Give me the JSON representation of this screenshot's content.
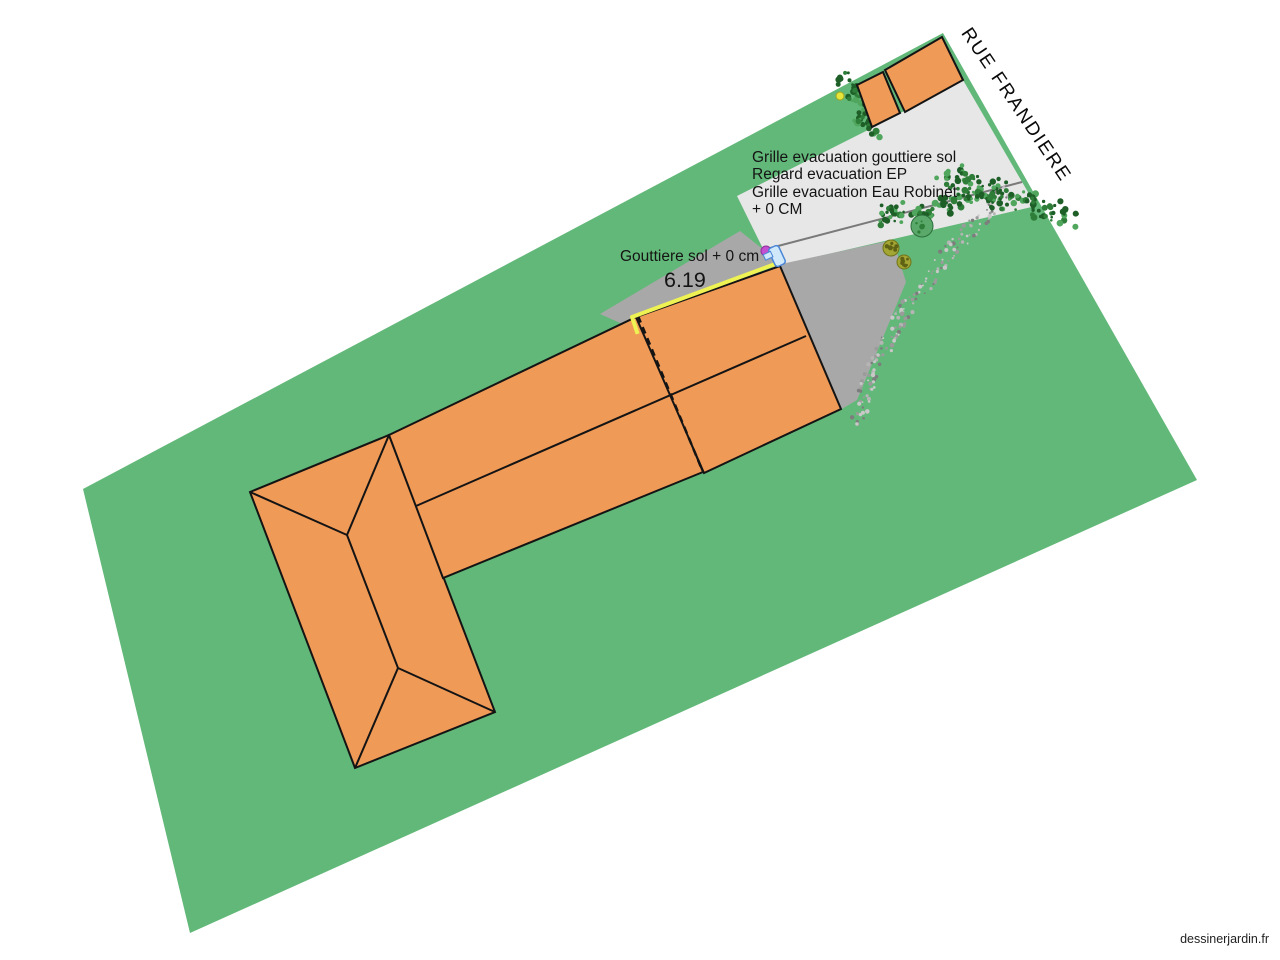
{
  "canvas": {
    "width": 1280,
    "height": 960,
    "background": "#ffffff"
  },
  "street_label": {
    "text": "RUE FRANDIERE"
  },
  "watermark": {
    "text": "dessinerjardin.fr"
  },
  "notes": {
    "evacuation": {
      "lines": [
        "Grille evacuation gouttiere sol",
        "Regard evacuation EP",
        "Grille evacuation Eau Robinet",
        "+ 0 CM"
      ]
    },
    "gutter": {
      "text": "Gouttiere sol + 0 cm"
    },
    "gutter_dimension": {
      "text": "6.19"
    }
  },
  "colors": {
    "lawn": "#62b879",
    "building": "#f09a57",
    "outline": "#141414",
    "driveway": "#e7e7e7",
    "terrace": "#a8a8a8",
    "gutter": "#eef253",
    "hedge_dark": "#1e5f28",
    "hedge_mid": "#2e7d38",
    "hedge_light": "#4fa65c",
    "gravel_a": "#9b9b9b",
    "gravel_b": "#c8c8c8",
    "gravel_c": "#7d7d7d",
    "gravel_d": "#b5b5b5"
  },
  "plan": {
    "elements": [
      {
        "name": "lawn-plot",
        "type": "polygon",
        "points": [
          [
            83,
            489
          ],
          [
            943,
            33
          ],
          [
            1197,
            480
          ],
          [
            190,
            933
          ]
        ],
        "fill": "lawn",
        "interactable": true
      },
      {
        "name": "driveway",
        "type": "polygon",
        "points": [
          [
            868,
            130
          ],
          [
            963,
            80
          ],
          [
            1036,
            206
          ],
          [
            772,
            267
          ],
          [
            737,
            196
          ]
        ],
        "fill": "driveway",
        "interactable": true
      },
      {
        "name": "driveway-edge-line",
        "type": "line",
        "x1": 755,
        "y1": 252,
        "x2": 1022,
        "y2": 182,
        "stroke": "#7a7a7a",
        "width": 2,
        "interactable": false
      },
      {
        "name": "terrace",
        "type": "polygon",
        "points": [
          [
            600,
            314
          ],
          [
            740,
            231
          ],
          [
            779,
            262
          ],
          [
            638,
            331
          ]
        ],
        "fill": "terrace",
        "interactable": true
      },
      {
        "name": "side-path",
        "type": "polygon",
        "points": [
          [
            772,
            266
          ],
          [
            893,
            240
          ],
          [
            906,
            282
          ],
          [
            857,
            400
          ],
          [
            840,
            410
          ]
        ],
        "fill": "terrace",
        "interactable": true
      },
      {
        "name": "gravel-path",
        "type": "gravel",
        "center": [
          [
            1008,
            192
          ],
          [
            952,
            248
          ],
          [
            902,
            314
          ],
          [
            871,
            376
          ],
          [
            856,
            426
          ]
        ],
        "half_width": 8,
        "step": 2.5,
        "interactable": true
      },
      {
        "name": "hedge-top",
        "type": "hedge",
        "from": [
          849,
          84
        ],
        "to": [
          872,
          126
        ],
        "blobs": 9,
        "radius": 7,
        "interactable": true
      },
      {
        "name": "hedge-driveway",
        "type": "hedge",
        "from": [
          876,
          214
        ],
        "to": [
          1000,
          197
        ],
        "blobs": 14,
        "radius": 7,
        "interactable": true
      },
      {
        "name": "hedge-street",
        "type": "hedge",
        "from": [
          944,
          176
        ],
        "to": [
          1068,
          216
        ],
        "blobs": 16,
        "radius": 9,
        "interactable": true
      },
      {
        "name": "bush-round",
        "type": "bush",
        "cx": 922,
        "cy": 226,
        "r": 11,
        "base": "#5aa96a",
        "edge": "#2c6e3c",
        "dot": "#2e7d38",
        "interactable": true
      },
      {
        "name": "bush-olive-1",
        "type": "bush",
        "cx": 891,
        "cy": 248,
        "r": 8,
        "base": "#a3a633",
        "edge": "#70731a",
        "dot": "#5f6214",
        "interactable": true
      },
      {
        "name": "bush-olive-2",
        "type": "bush",
        "cx": 904,
        "cy": 262,
        "r": 7,
        "base": "#a3a633",
        "edge": "#70731a",
        "dot": "#5f6214",
        "interactable": true
      },
      {
        "name": "marker-yellow-dot",
        "type": "dot",
        "cx": 840,
        "cy": 96,
        "r": 4,
        "fill": "#e4e63a",
        "stroke": "#a3a51f",
        "interactable": true
      },
      {
        "name": "house-main-block",
        "type": "polygon",
        "points": [
          [
            250,
            492
          ],
          [
            389,
            435
          ],
          [
            495,
            712
          ],
          [
            355,
            768
          ]
        ],
        "fill": "building",
        "stroke": "outline",
        "width": 2,
        "interactable": true
      },
      {
        "name": "house-wing",
        "type": "polygon",
        "points": [
          [
            389,
            435
          ],
          [
            638,
            316
          ],
          [
            703,
            472
          ],
          [
            443,
            578
          ]
        ],
        "fill": "building",
        "stroke": "outline",
        "width": 2,
        "interactable": true
      },
      {
        "name": "house-extension",
        "type": "polygon",
        "points": [
          [
            636,
            317
          ],
          [
            780,
            266
          ],
          [
            841,
            409
          ],
          [
            704,
            473
          ]
        ],
        "fill": "building",
        "stroke": "outline",
        "width": 2,
        "interactable": true
      },
      {
        "name": "roof-ridge-main",
        "type": "line",
        "x1": 347,
        "y1": 535,
        "x2": 398,
        "y2": 668,
        "stroke": "outline",
        "width": 2,
        "interactable": false
      },
      {
        "name": "roof-hip-nw",
        "type": "line",
        "x1": 250,
        "y1": 492,
        "x2": 347,
        "y2": 535,
        "stroke": "outline",
        "width": 2,
        "interactable": false
      },
      {
        "name": "roof-hip-ne",
        "type": "line",
        "x1": 389,
        "y1": 435,
        "x2": 347,
        "y2": 535,
        "stroke": "outline",
        "width": 2,
        "interactable": false
      },
      {
        "name": "roof-hip-sw",
        "type": "line",
        "x1": 355,
        "y1": 768,
        "x2": 398,
        "y2": 668,
        "stroke": "outline",
        "width": 2,
        "interactable": false
      },
      {
        "name": "roof-hip-se",
        "type": "line",
        "x1": 495,
        "y1": 712,
        "x2": 398,
        "y2": 668,
        "stroke": "outline",
        "width": 2,
        "interactable": false
      },
      {
        "name": "roof-ridge-wing",
        "type": "line",
        "x1": 416,
        "y1": 506,
        "x2": 806,
        "y2": 336,
        "stroke": "outline",
        "width": 2,
        "interactable": false
      },
      {
        "name": "party-wall-dashed",
        "type": "line",
        "x1": 638,
        "y1": 316,
        "x2": 703,
        "y2": 472,
        "stroke": "outline",
        "width": 2.5,
        "dash": "7 5",
        "interactable": false
      },
      {
        "name": "street-shed-large",
        "type": "polygon",
        "points": [
          [
            885,
            70
          ],
          [
            942,
            37
          ],
          [
            963,
            80
          ],
          [
            905,
            112
          ]
        ],
        "fill": "building",
        "stroke": "outline",
        "width": 2,
        "interactable": true
      },
      {
        "name": "street-shed-small",
        "type": "polygon",
        "points": [
          [
            857,
            85
          ],
          [
            883,
            72
          ],
          [
            900,
            113
          ],
          [
            872,
            127
          ]
        ],
        "fill": "building",
        "stroke": "outline",
        "width": 2,
        "interactable": true
      },
      {
        "name": "gutter-line",
        "type": "polyline",
        "points": [
          [
            637,
            332
          ],
          [
            632,
            317
          ],
          [
            778,
            263
          ]
        ],
        "stroke": "gutter",
        "width": 4,
        "interactable": true
      },
      {
        "name": "marker-magenta-dot",
        "type": "dot",
        "cx": 766,
        "cy": 251,
        "r": 5,
        "fill": "#c44fd0",
        "stroke": "#8e2f9c",
        "interactable": true
      },
      {
        "name": "water-tap-icon",
        "type": "tap",
        "x": 777,
        "y": 256,
        "interactable": true
      }
    ]
  }
}
